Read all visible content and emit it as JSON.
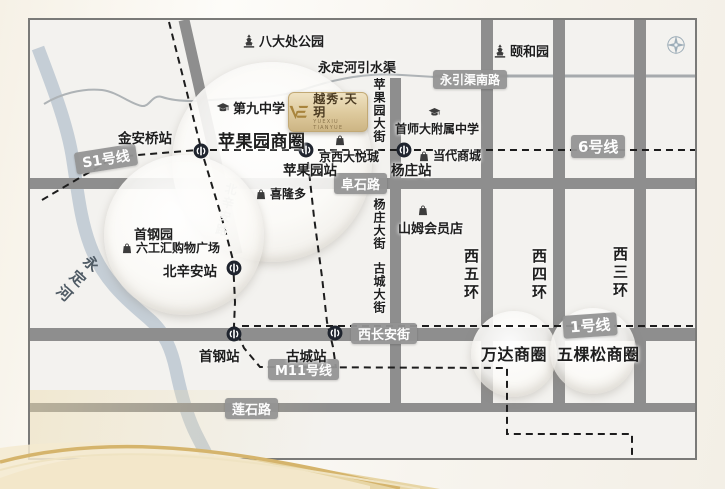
{
  "logo": {
    "name_cn": "越秀·天玥",
    "name_en": "YUEXIU TIANYUE",
    "monogram_icon": "VE-monogram"
  },
  "transit": {
    "s1": "S1号线",
    "line6": "6号线",
    "line1": "1号线",
    "m11": "M11号线"
  },
  "roads": {
    "yongyin": "永引渠南路",
    "fushi": "阜石路",
    "changan": "西长安街",
    "lianshi": "莲石路",
    "beixinan_rd": "北辛安路",
    "pingguoyuan_st": "苹果园大街",
    "yangzhuang_st": "杨庄大街",
    "gucheng_st": "古城大街",
    "ring5": "西五环",
    "ring4": "西四环",
    "ring3": "西三环"
  },
  "water": {
    "river": "永定河",
    "canal": "永定河引水渠"
  },
  "stations": {
    "jinanqiao": "金安桥站",
    "pingguoyuan": "苹果园站",
    "yangzhuang": "杨庄站",
    "beixinan": "北辛安站",
    "shougang": "首钢站",
    "gucheng": "古城站"
  },
  "districts": {
    "pingguoyuan": "苹果园商圈",
    "wanda": "万达商圈",
    "wukesong": "五棵松商圈"
  },
  "pois": {
    "badachu": "八大处公园",
    "summer_palace": "颐和园",
    "no9_school": "第九中学",
    "cnu_school": "首师大附属中学",
    "joycity": "京西大悦城",
    "dangdai": "当代商城",
    "xilongduo": "喜隆多",
    "sams": "山姆会员店",
    "shougang_park": "首钢园",
    "liugonghui": "六工汇购物广场"
  },
  "colors": {
    "road": "#8e8e8e",
    "river": "#c5ced6",
    "pill": "#949493",
    "metro_icon": "#1f242e",
    "gold_accent": "#d5ba7d",
    "map_bg": "#f3f2ef"
  }
}
